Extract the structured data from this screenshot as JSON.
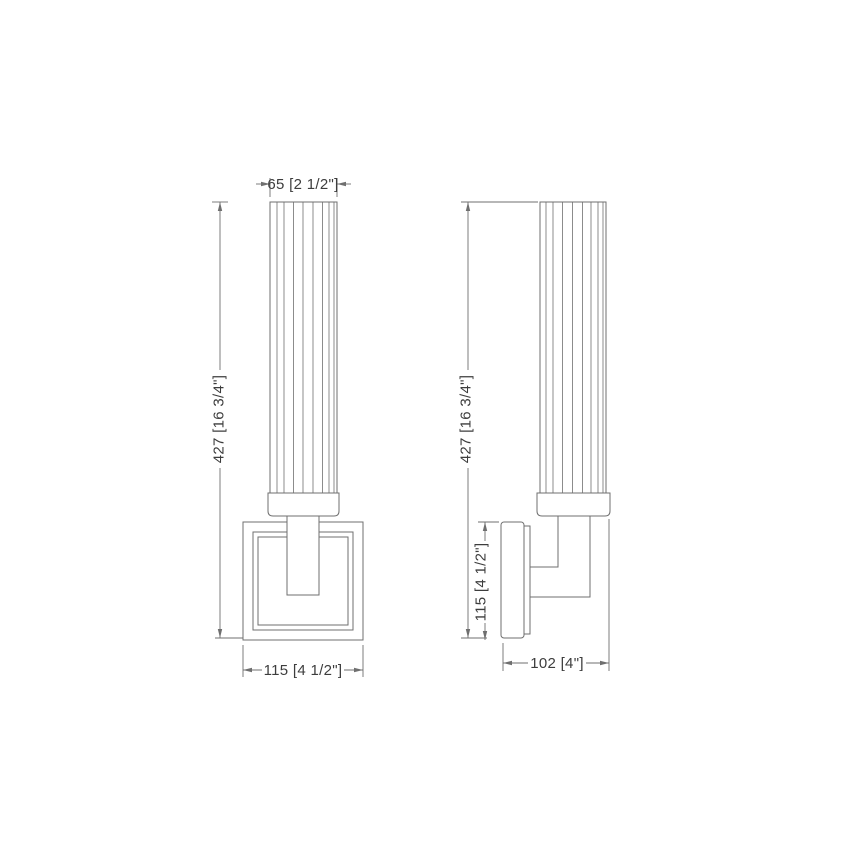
{
  "colors": {
    "line": "#6f6f6f",
    "text": "#3d3d3d",
    "background": "#ffffff"
  },
  "front_view": {
    "dim_shade_width": "65 [2 1/2\"]",
    "dim_overall_height": "427 [16 3/4\"]",
    "dim_backplate_width": "115 [4 1/2\"]"
  },
  "side_view": {
    "dim_overall_height": "427 [16 3/4\"]",
    "dim_backplate_height": "115 [4 1/2\"]",
    "dim_overall_depth": "102 [4\"]"
  }
}
